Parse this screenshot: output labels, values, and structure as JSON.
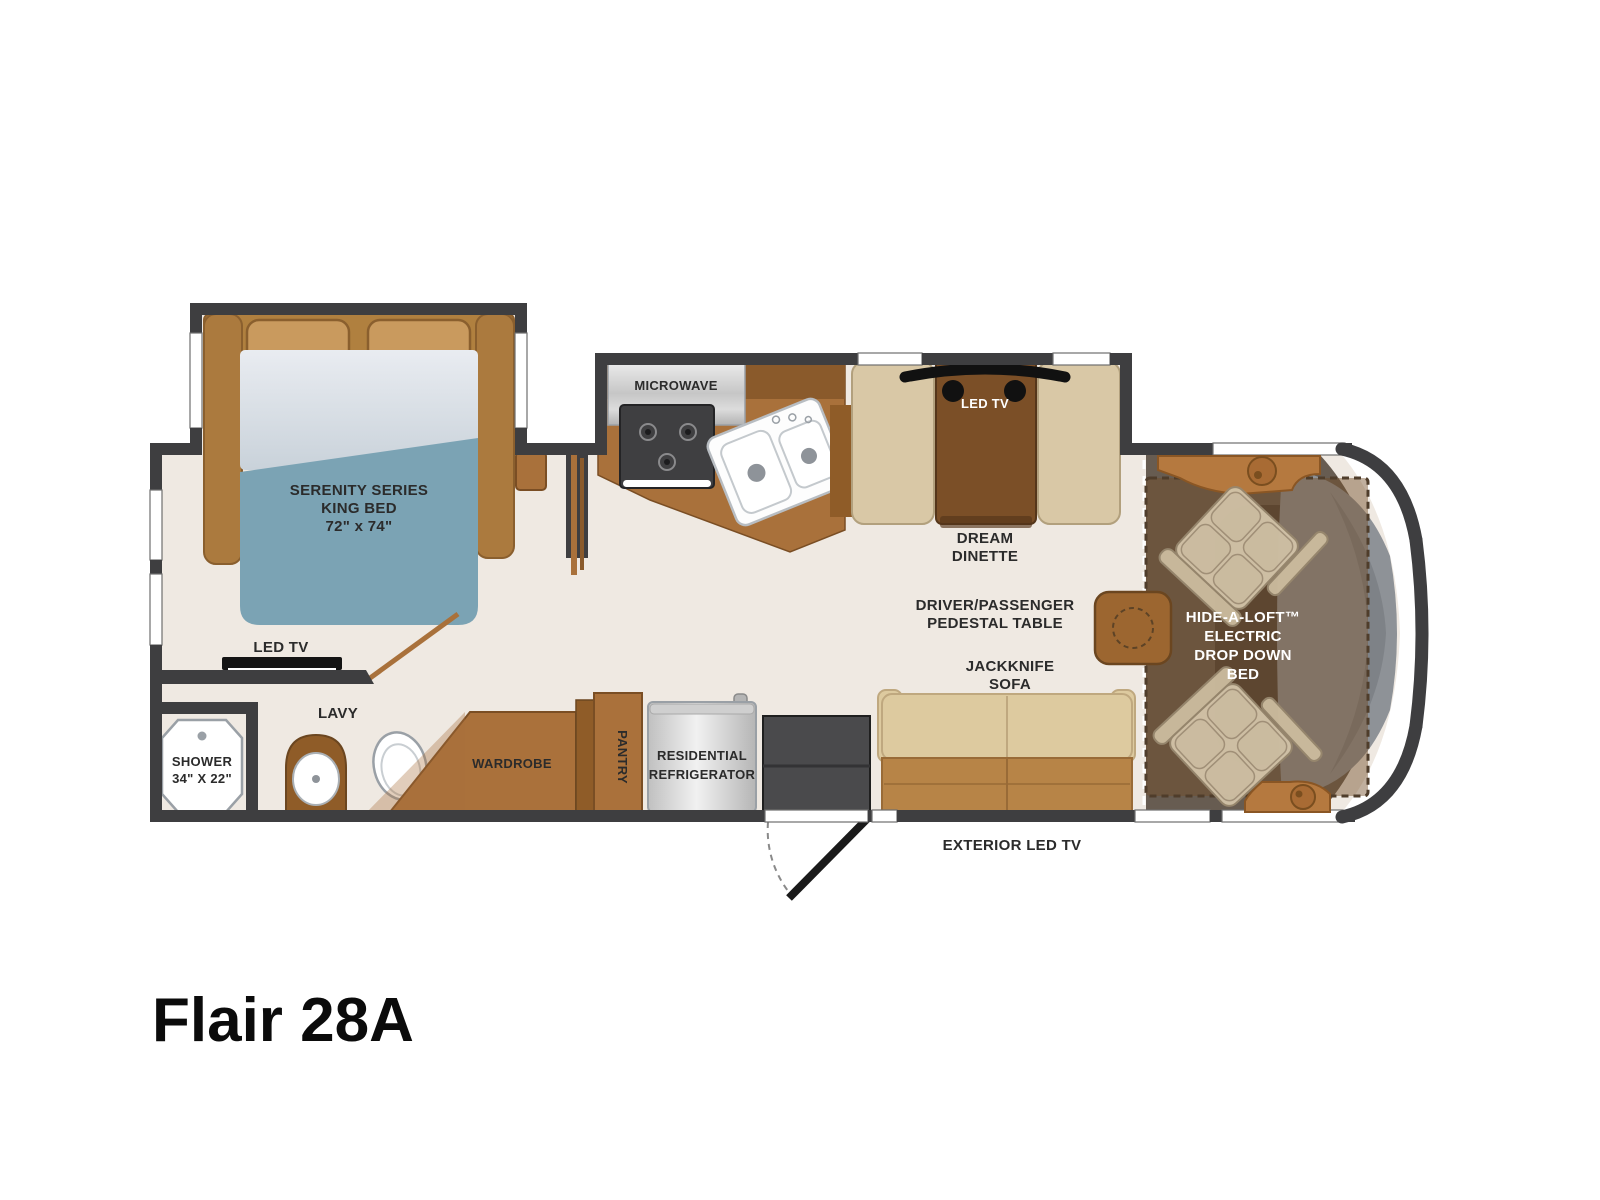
{
  "title": "Flair 28A",
  "palette": {
    "wall": "#3e3e40",
    "floor": "#efe9e2",
    "wood_dark": "#8a5a2b",
    "wood_mid": "#a9713b",
    "wood_light": "#b5793f",
    "mattress_blue": "#7ba3b4",
    "bench_beige": "#d9c8a6",
    "sofa_tan": "#ddca9f",
    "sofa_base": "#b78447",
    "appliance_silver": "#d9d9d9",
    "cooktop_black": "#3f3f41",
    "windshield_gray": "#8e9297",
    "drop_bed_overlay": "rgba(115,78,40,0.45)",
    "label_ink": "#2b2b2b"
  },
  "labels": {
    "bed": [
      "SERENITY SERIES",
      "KING BED",
      "72\" x 74\""
    ],
    "bedroom_tv": "LED TV",
    "shower": [
      "SHOWER",
      "34\" X 22\""
    ],
    "lavy": "LAVY",
    "wardrobe": "WARDROBE",
    "microwave": "MICROWAVE",
    "pantry": "PANTRY",
    "refrigerator": [
      "RESIDENTIAL",
      "REFRIGERATOR"
    ],
    "dinette_tv": "LED TV",
    "dinette": [
      "DREAM",
      "DINETTE"
    ],
    "pedestal_table": [
      "DRIVER/PASSENGER",
      "PEDESTAL TABLE"
    ],
    "jackknife_sofa": [
      "JACKKNIFE",
      "SOFA"
    ],
    "exterior_tv": "EXTERIOR LED TV",
    "drop_down_bed": [
      "HIDE-A-LOFT™",
      "ELECTRIC",
      "DROP DOWN",
      "BED"
    ]
  }
}
